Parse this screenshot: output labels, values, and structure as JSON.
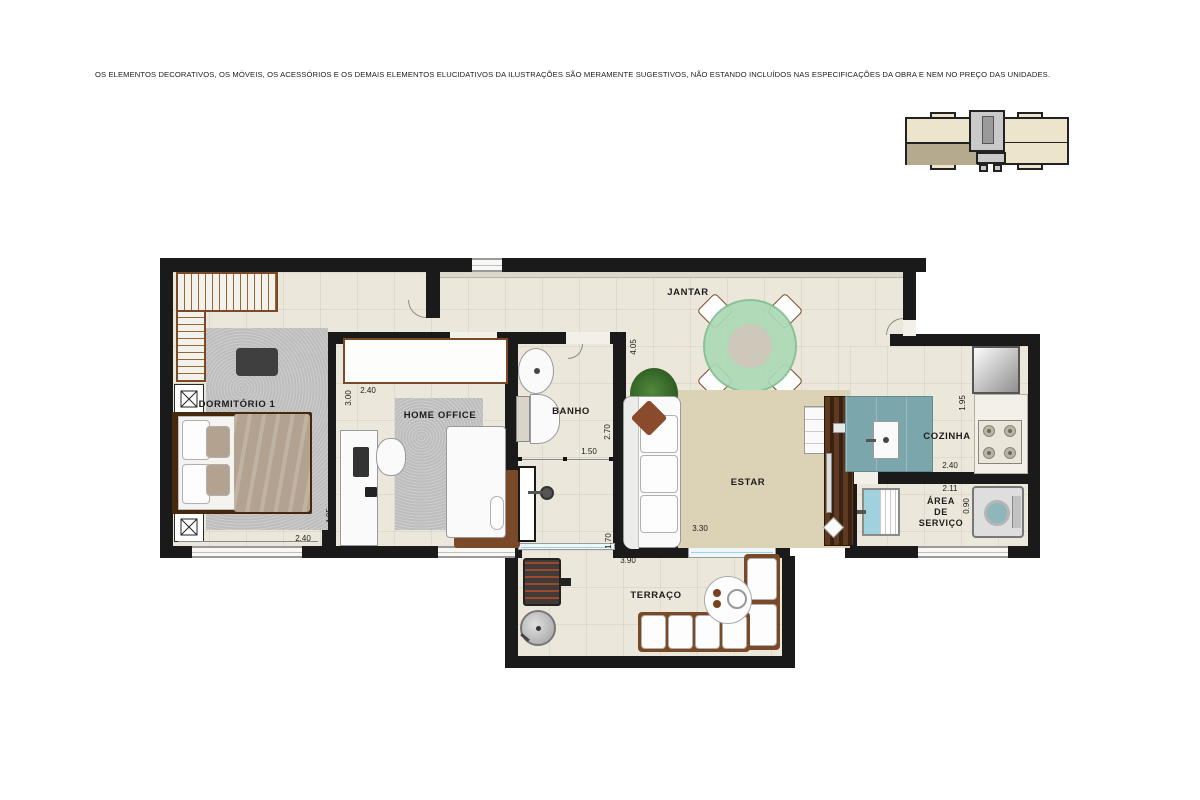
{
  "disclaimer": "OS ELEMENTOS DECORATIVOS, OS MÓVEIS, OS ACESSÓRIOS E OS DEMAIS ELEMENTOS ELUCIDATIVOS DA ILUSTRAÇÕES SÃO MERAMENTE SUGESTIVOS, NÃO ESTANDO INCLUÍDOS NAS ESPECIFICAÇÕES DA OBRA E NEM NO PREÇO DAS UNIDADES.",
  "rooms": {
    "dormitorio": {
      "label": "DORMITÓRIO 1"
    },
    "home_office": {
      "label": "HOME OFFICE"
    },
    "banho": {
      "label": "BANHO"
    },
    "jantar": {
      "label": "JANTAR"
    },
    "estar": {
      "label": "ESTAR"
    },
    "cozinha": {
      "label": "COZINHA"
    },
    "area_servico": {
      "l1": "ÁREA",
      "l2": "DE",
      "l3": "SERVIÇO"
    },
    "terraco": {
      "label": "TERRAÇO"
    }
  },
  "dims": {
    "dorm_w": "2.40",
    "dorm_h": "4.05",
    "ho_w": "2.40",
    "ho_d": "3.00",
    "banho_h": "2.70",
    "banho_w": "1.50",
    "shower_h": "1.70",
    "jantar_h": "4.05",
    "estar_w": "3.30",
    "coz_h": "1.95",
    "coz_w": "2.40",
    "serv_w": "2.11",
    "serv_h": "0.90",
    "terr_w": "3.90"
  },
  "colors": {
    "wall": "#1a1a1a",
    "floor": "#ebe7da",
    "rug_gray": "#bdbdbd",
    "rug_beige": "#dcd2b6",
    "wood": "#7a4a28",
    "wood_dark": "#45290f",
    "table_green": "#abd9b6",
    "table_green_edge": "#82bf92",
    "counter_teal": "#7ba6ab",
    "glass_blue": "#9fd2de",
    "white_furn": "#fafafa",
    "taupe": "#b3a28f",
    "key_beige": "#ede4cc",
    "key_dark": "#b5a98e",
    "key_gray": "#c9c9c9",
    "text": "#1d1d1d"
  }
}
